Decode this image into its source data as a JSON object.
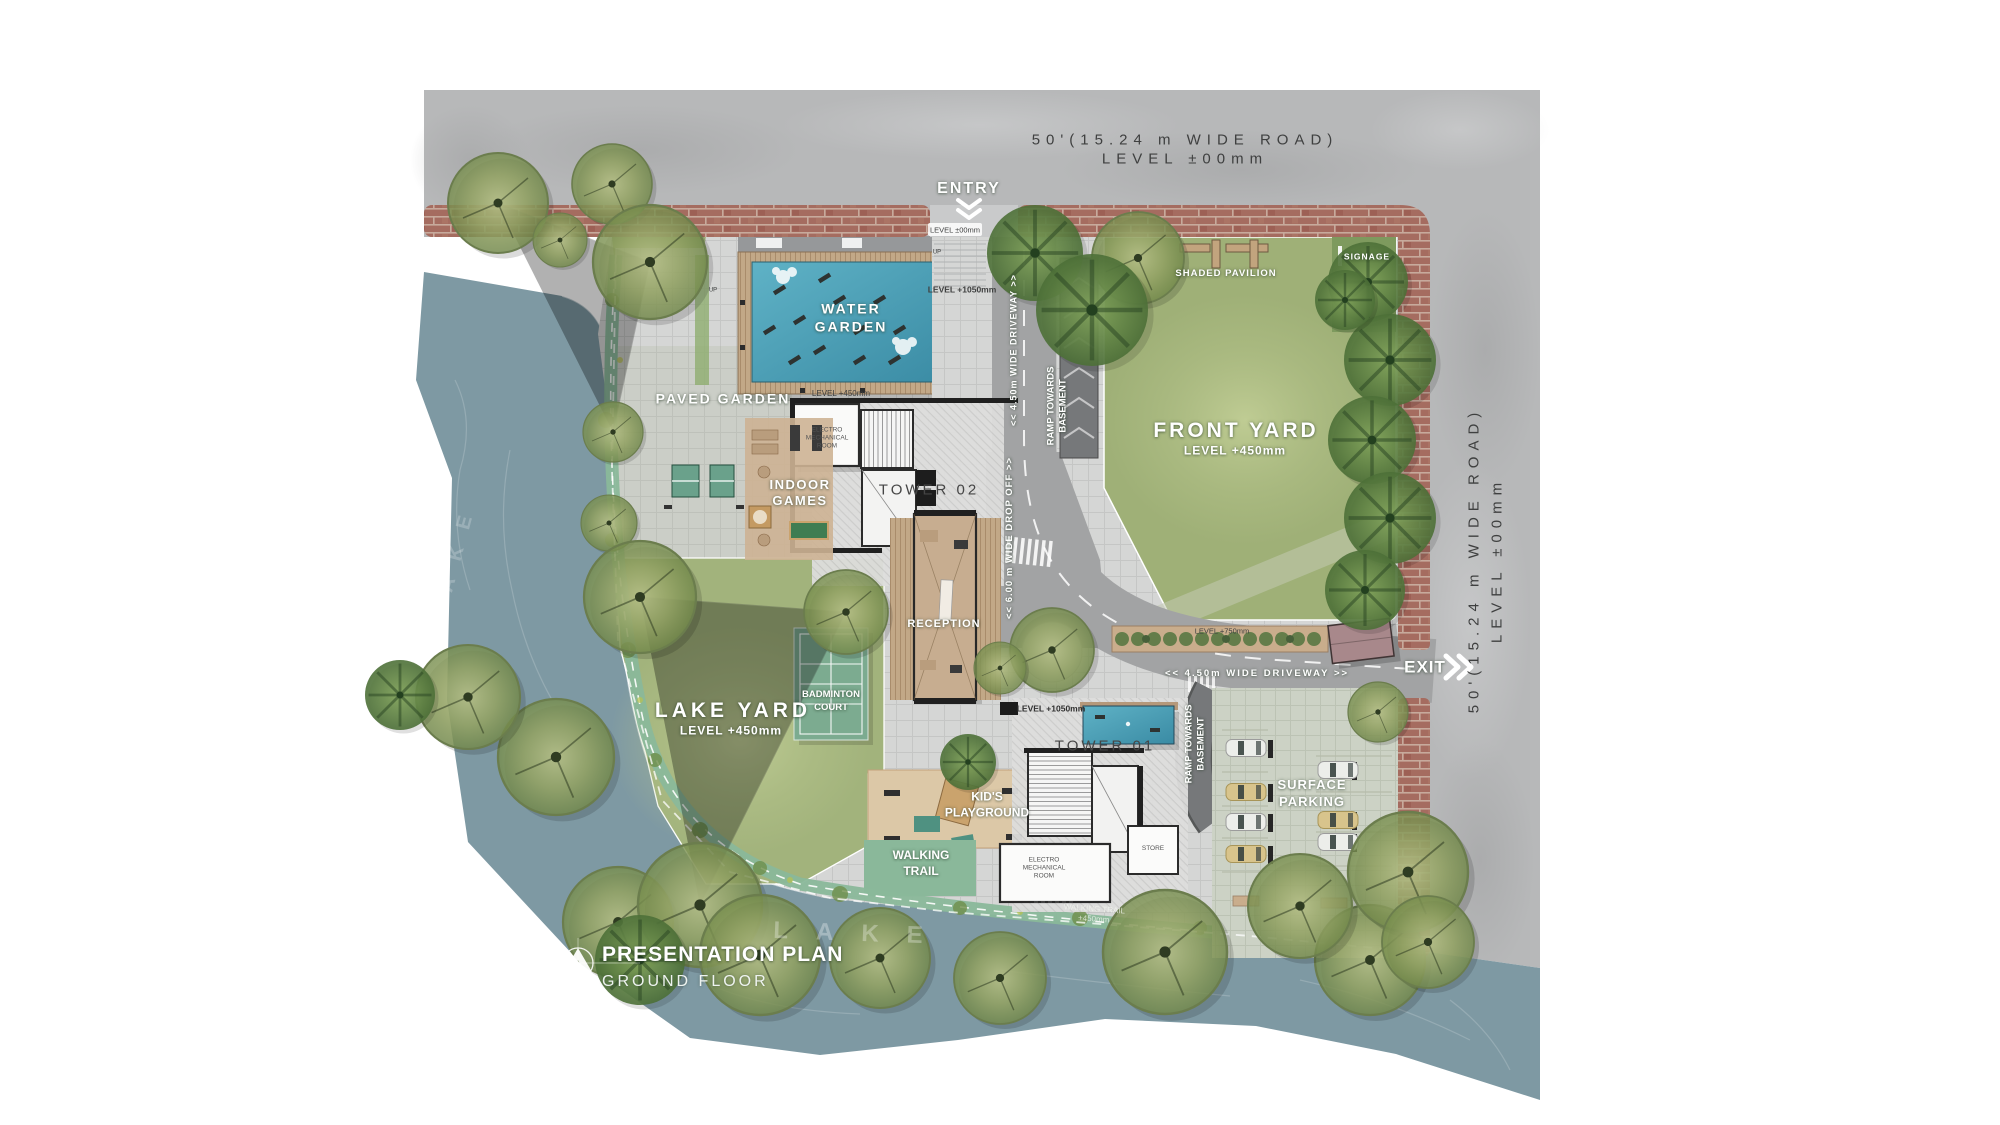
{
  "title_block": {
    "title": "PRESENTATION PLAN",
    "subtitle": "GROUND FLOOR"
  },
  "roads": {
    "top_name": "50'(15.24 m WIDE ROAD)",
    "top_level": "LEVEL ±00mm",
    "right_name": "50'(15.24 m WIDE ROAD)",
    "right_level": "LEVEL ±00mm"
  },
  "gates": {
    "entry": "ENTRY",
    "exit": "EXIT"
  },
  "areas": {
    "water_garden_1": "WATER",
    "water_garden_2": "GARDEN",
    "paved_garden": "PAVED GARDEN",
    "indoor_games_1": "INDOOR",
    "indoor_games_2": "GAMES",
    "front_yard": "FRONT YARD",
    "lake_yard": "LAKE YARD",
    "badminton_1": "BADMINTON",
    "badminton_2": "COURT",
    "kids_1": "KID'S",
    "kids_2": "PLAYGROUND",
    "walking_1": "WALKING",
    "walking_2": "TRAIL",
    "surface_parking_1": "SURFACE",
    "surface_parking_2": "PARKING",
    "shaded_pavilion": "SHADED PAVILION",
    "signage": "SIGNAGE",
    "reception": "RECEPTION",
    "tower_01": "TOWER 01",
    "tower_02": "TOWER 02",
    "store": "STORE",
    "electro_1": "ELECTRO",
    "electro_2": "MECHANICAL",
    "electro_3": "ROOM"
  },
  "circulation": {
    "driveway_450": "<< 4.50m WIDE DRIVEWAY >>",
    "drop_off_600": "<< 6.00 m WIDE DROP OFF >>",
    "ramp_1": "RAMP TOWARDS",
    "ramp_2": "BASEMENT",
    "up": "UP",
    "trail_faint_1": "WALKING TRAIL",
    "trail_faint_2": "+450mm"
  },
  "levels": {
    "l00": "LEVEL ±00mm",
    "l450": "LEVEL +450mm",
    "l750": "LEVEL +750mm",
    "l1050": "LEVEL +1050mm"
  },
  "water": {
    "lake_watermark": "LAKE"
  },
  "colors": {
    "concrete": "#b7b8b9",
    "brick": "#a56c60",
    "river": "#7e99a3",
    "grass": "#a2b37c",
    "pool": "#4ba0b6",
    "court": "#7cab90",
    "trail": "#8ab89a",
    "sand": "#dcc8a7",
    "label_white": "#ffffff",
    "label_dark": "#3f4040"
  }
}
